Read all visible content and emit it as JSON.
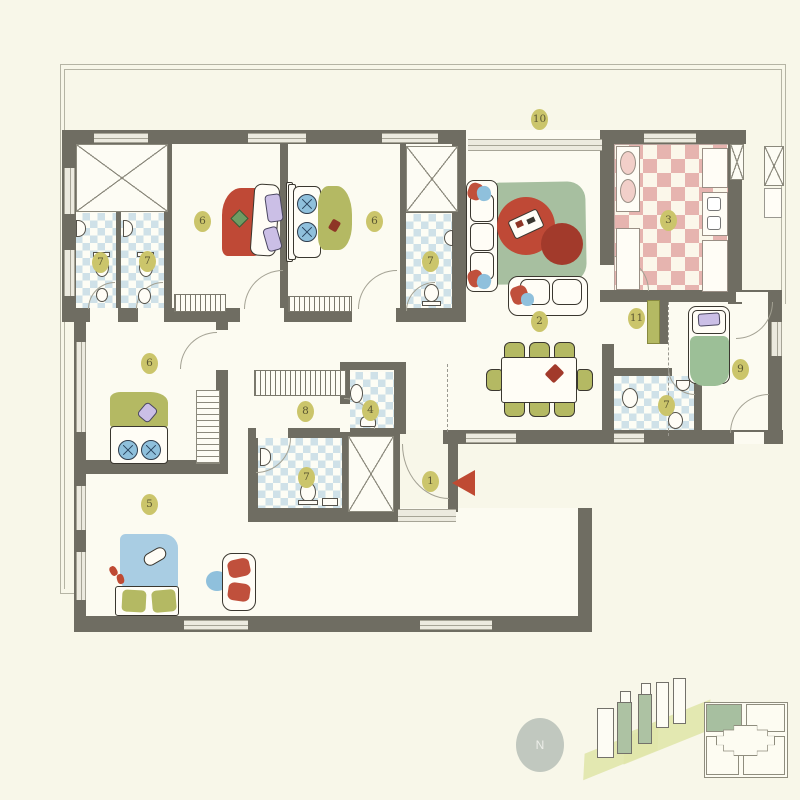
{
  "title": "apartment-floor-plan",
  "palette": {
    "bg": "#f8f7e9",
    "wall": "#6f6d62",
    "badge": "#cbc56b",
    "badgeText": "#5c5833",
    "tileBlue": "#cfe1e8",
    "tilePink": "#e6b4af",
    "rug": "#a7bfa0",
    "tableRed": "#bf4936",
    "tableRedDark": "#a23a2b",
    "olive": "#b4b963",
    "bedBlue": "#a9cde3",
    "pillowBlue": "#8fc0dc",
    "purple": "#cbbfe6",
    "bedGreen": "#9cbf97",
    "accentRed": "#c0503c",
    "arrowRed": "#bf4a33",
    "buildingGreen": "#adc2a3",
    "baseOlive": "#e0e6ab",
    "compassBg": "#c1c8bf",
    "compassText": "#edeee9"
  },
  "rooms": [
    {
      "num": "1",
      "name": "entrance",
      "x": 431,
      "y": 482
    },
    {
      "num": "2",
      "name": "living-dining",
      "x": 540,
      "y": 322
    },
    {
      "num": "3",
      "name": "kitchen",
      "x": 669,
      "y": 221
    },
    {
      "num": "4",
      "name": "bathroom",
      "x": 371,
      "y": 411
    },
    {
      "num": "5",
      "name": "bedroom",
      "x": 150,
      "y": 505
    },
    {
      "num": "6",
      "name": "bedroom",
      "x": 203,
      "y": 222
    },
    {
      "num": "6",
      "name": "bedroom",
      "x": 375,
      "y": 222
    },
    {
      "num": "6",
      "name": "bedroom",
      "x": 150,
      "y": 364
    },
    {
      "num": "7",
      "name": "bathroom",
      "x": 101,
      "y": 263
    },
    {
      "num": "7",
      "name": "bathroom",
      "x": 148,
      "y": 262
    },
    {
      "num": "7",
      "name": "bathroom",
      "x": 431,
      "y": 262
    },
    {
      "num": "7",
      "name": "bathroom",
      "x": 667,
      "y": 406
    },
    {
      "num": "7",
      "name": "bathroom",
      "x": 307,
      "y": 478
    },
    {
      "num": "8",
      "name": "corridor",
      "x": 306,
      "y": 412
    },
    {
      "num": "9",
      "name": "bedroom",
      "x": 741,
      "y": 370
    },
    {
      "num": "10",
      "name": "terrace",
      "x": 540,
      "y": 120
    },
    {
      "num": "11",
      "name": "hallway",
      "x": 637,
      "y": 319
    }
  ],
  "compass": {
    "letter": "N"
  }
}
